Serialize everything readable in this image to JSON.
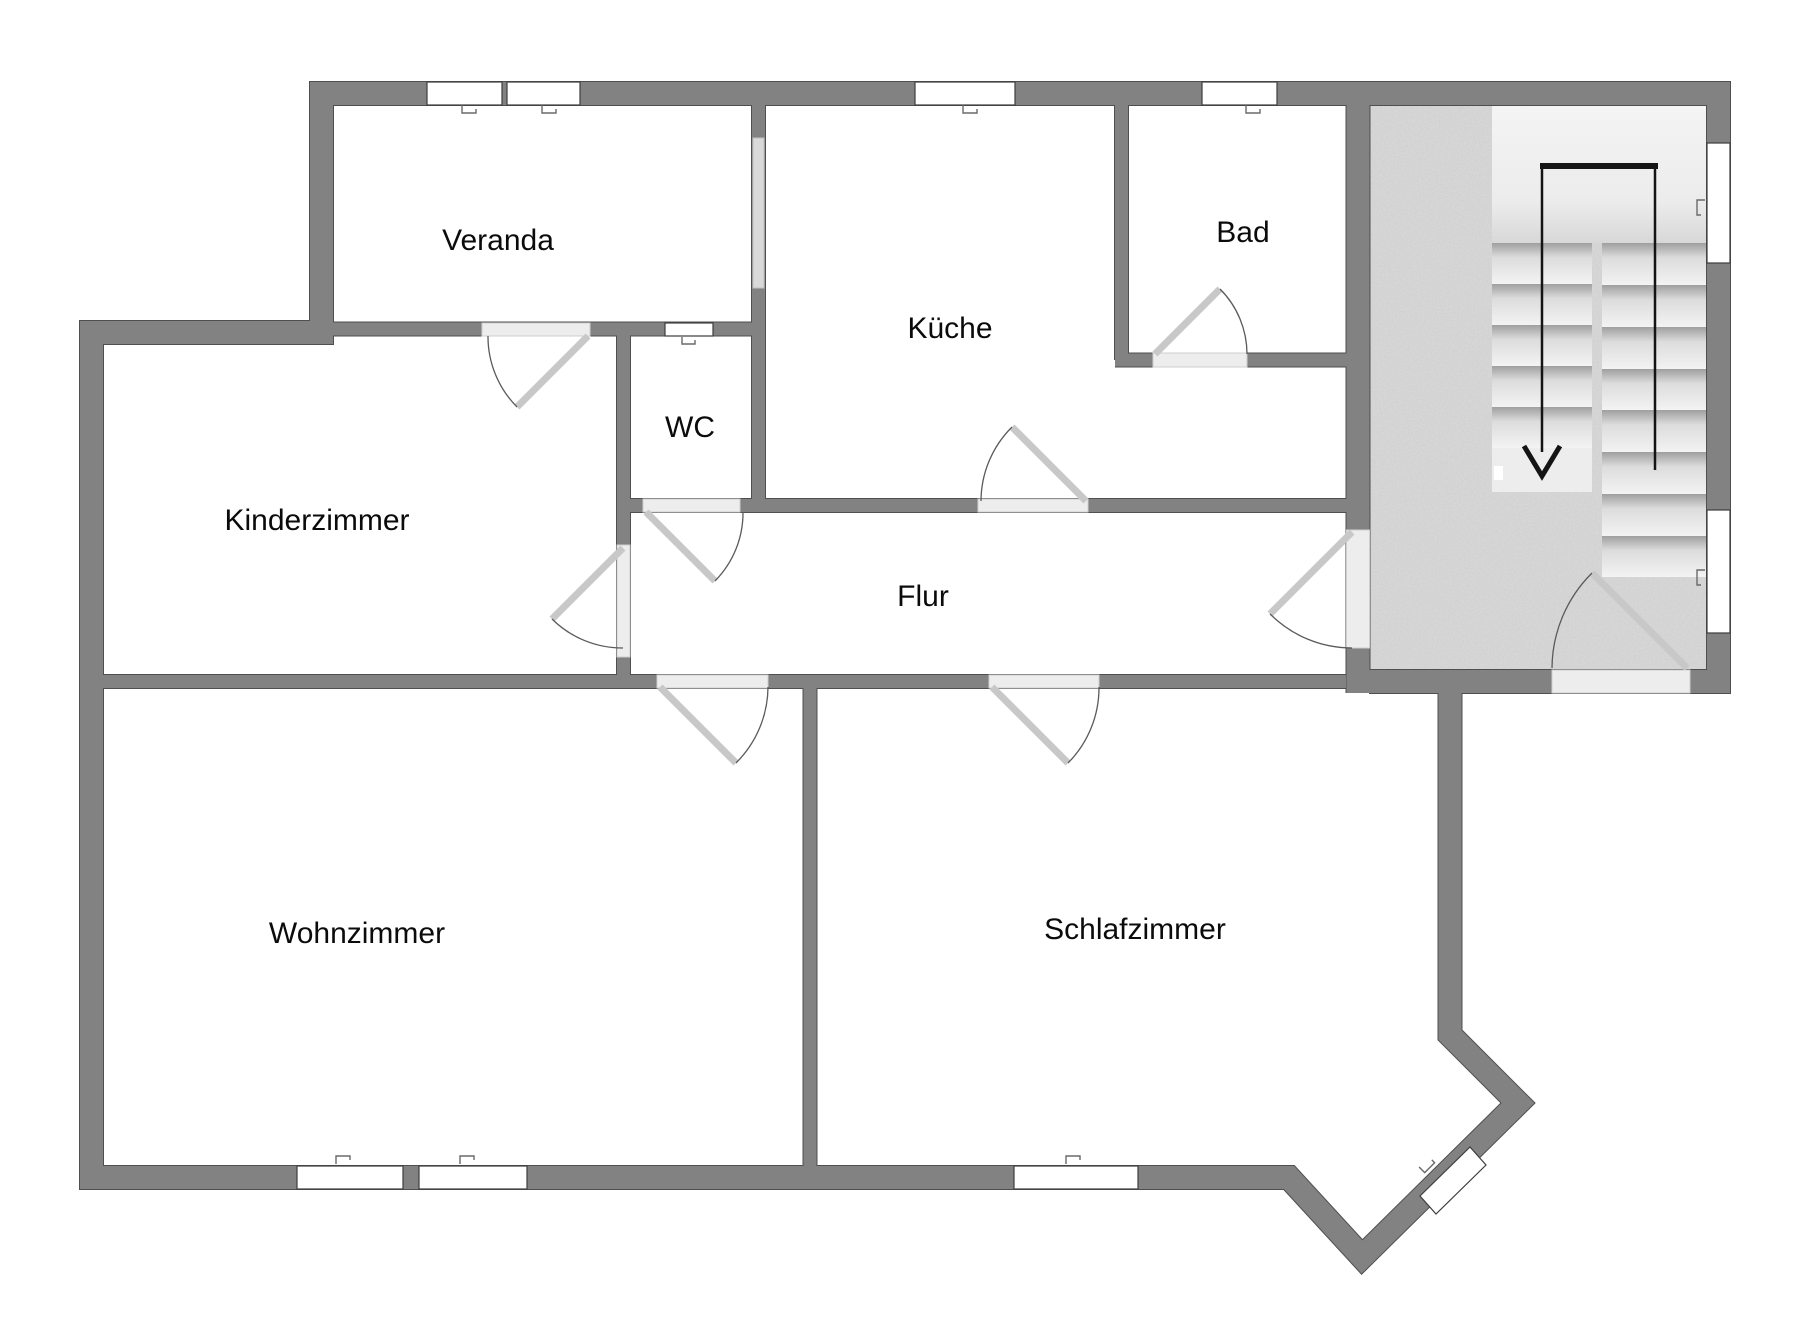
{
  "plan": {
    "type": "floorplan",
    "language": "de",
    "rooms": [
      {
        "id": "veranda",
        "label": "Veranda"
      },
      {
        "id": "kueche",
        "label": "Küche"
      },
      {
        "id": "bad",
        "label": "Bad"
      },
      {
        "id": "wc",
        "label": "WC"
      },
      {
        "id": "kinderzimmer",
        "label": "Kinderzimmer"
      },
      {
        "id": "flur",
        "label": "Flur"
      },
      {
        "id": "wohnzimmer",
        "label": "Wohnzimmer"
      },
      {
        "id": "schlafzimmer",
        "label": "Schlafzimmer"
      }
    ],
    "stairwell": {
      "stair_flights": 2,
      "arrow_direction": "down",
      "floor_texture": "concrete-speckle"
    },
    "counts": {
      "doors": 9,
      "windows": 11
    },
    "colors": {
      "wall": "#828282",
      "wall_outline": "#4f4f4f",
      "floor": "#ffffff",
      "stair_floor": "#c9c9c9",
      "door_leaf": "#c8c8c8",
      "door_threshold": "#ededed",
      "window": "#ffffff",
      "glass_panel": "#d9d9d9",
      "arrow": "#141414",
      "label_text": "#0b0b0b"
    }
  }
}
